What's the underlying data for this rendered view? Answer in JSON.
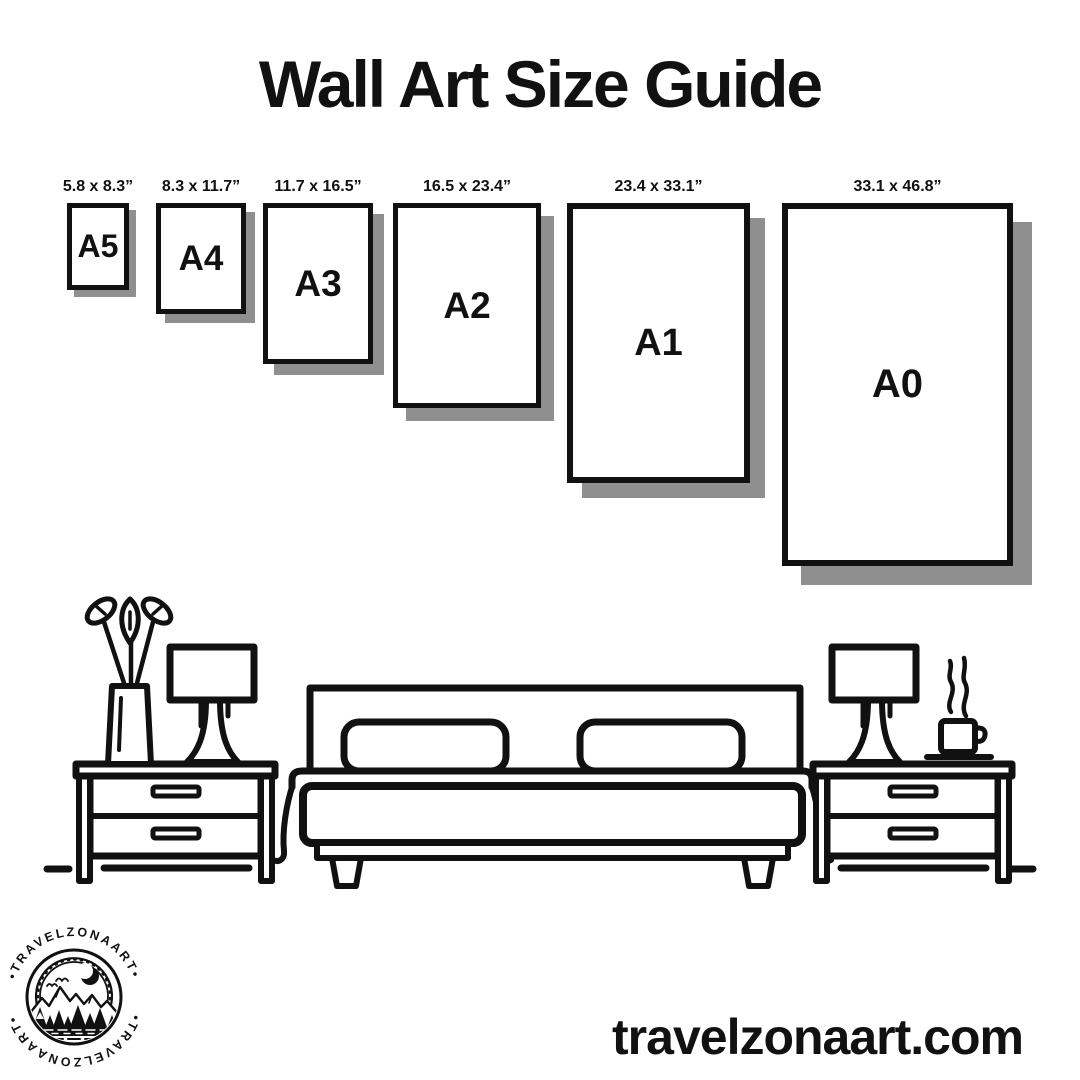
{
  "page": {
    "title": "Wall Art Size Guide",
    "website": "travelzonaart.com"
  },
  "sizes": [
    {
      "label": "A5",
      "dimensions": "5.8 x 8.3”"
    },
    {
      "label": "A4",
      "dimensions": "8.3 x 11.7”"
    },
    {
      "label": "A3",
      "dimensions": "11.7 x 16.5”"
    },
    {
      "label": "A2",
      "dimensions": "16.5 x 23.4”"
    },
    {
      "label": "A1",
      "dimensions": "23.4 x 33.1”"
    },
    {
      "label": "A0",
      "dimensions": "33.1 x 46.8”"
    }
  ],
  "logo": {
    "brand": "TRAVELZONAART",
    "ring_top": "•TRAVELZONAART•",
    "ring_bottom": "•TRAVELZONAART•"
  },
  "illustration": {
    "icons": [
      "vase-with-plant-icon",
      "table-lamp-left-icon",
      "nightstand-left-icon",
      "double-bed-icon",
      "nightstand-right-icon",
      "table-lamp-right-icon",
      "steaming-coffee-cup-icon"
    ]
  },
  "colors": {
    "ink": "#111111",
    "frame_shadow": "#8f8f8f",
    "background": "#ffffff"
  }
}
